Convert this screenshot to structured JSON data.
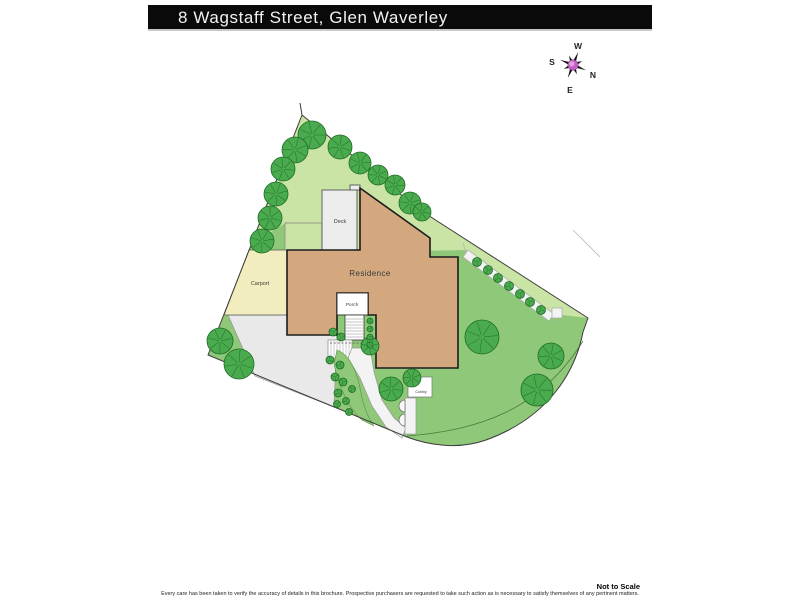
{
  "header": {
    "title": "8 Wagstaff Street, Glen Waverley"
  },
  "compass": {
    "north": "N",
    "south": "S",
    "east": "E",
    "west": "W"
  },
  "plan": {
    "labels": {
      "residence": "Residence",
      "deck": "Deck",
      "carport": "Carport",
      "porch": "Porch",
      "cubby": "Cubby"
    },
    "colors": {
      "lawn": "#8fc879",
      "lawn_light": "#c9e4a4",
      "tree_fill": "#4aaa4e",
      "tree_line": "#1d6b24",
      "driveway": "#e9e9e9",
      "carport": "#f2edbe",
      "residence": "#d3a87e",
      "outline": "#1c1c1c",
      "deck": "#ededed",
      "porch": "#ffffff",
      "path": "#f3f3f3",
      "boundary": "#3c3c3c",
      "compass_pink": "#c45fc4",
      "compass_pink_light": "#e49ce4",
      "header_bg": "#0a0a0a",
      "header_text": "#f2f2f2"
    },
    "trees": [
      {
        "x": 112,
        "y": 35,
        "r": 14
      },
      {
        "x": 95,
        "y": 50,
        "r": 13
      },
      {
        "x": 83,
        "y": 69,
        "r": 12
      },
      {
        "x": 76,
        "y": 94,
        "r": 12
      },
      {
        "x": 70,
        "y": 118,
        "r": 12
      },
      {
        "x": 62,
        "y": 141,
        "r": 12
      },
      {
        "x": 140,
        "y": 47,
        "r": 12
      },
      {
        "x": 160,
        "y": 63,
        "r": 11
      },
      {
        "x": 178,
        "y": 75,
        "r": 10
      },
      {
        "x": 195,
        "y": 85,
        "r": 10
      },
      {
        "x": 210,
        "y": 103,
        "r": 11
      },
      {
        "x": 222,
        "y": 112,
        "r": 9
      },
      {
        "x": 20,
        "y": 241,
        "r": 13
      },
      {
        "x": 39,
        "y": 264,
        "r": 15
      },
      {
        "x": 282,
        "y": 237,
        "r": 17
      },
      {
        "x": 351,
        "y": 256,
        "r": 13
      },
      {
        "x": 337,
        "y": 290,
        "r": 16
      },
      {
        "x": 212,
        "y": 278,
        "r": 9
      },
      {
        "x": 191,
        "y": 289,
        "r": 12
      },
      {
        "x": 170,
        "y": 246,
        "r": 9
      }
    ],
    "bushes": [
      {
        "x": 133,
        "y": 232,
        "r": 4
      },
      {
        "x": 141,
        "y": 237,
        "r": 4
      },
      {
        "x": 130,
        "y": 260,
        "r": 4
      },
      {
        "x": 140,
        "y": 265,
        "r": 4
      },
      {
        "x": 135,
        "y": 277,
        "r": 4
      },
      {
        "x": 143,
        "y": 282,
        "r": 4
      },
      {
        "x": 138,
        "y": 293,
        "r": 4
      },
      {
        "x": 146,
        "y": 301,
        "r": 3.5
      },
      {
        "x": 137,
        "y": 304,
        "r": 3.5
      },
      {
        "x": 152,
        "y": 289,
        "r": 3.5
      },
      {
        "x": 149,
        "y": 312,
        "r": 3.5
      },
      {
        "x": 170,
        "y": 221,
        "r": 3
      },
      {
        "x": 170,
        "y": 229,
        "r": 3
      },
      {
        "x": 170,
        "y": 237,
        "r": 3
      },
      {
        "x": 170,
        "y": 245,
        "r": 3
      }
    ],
    "hedge_bushes": [
      {
        "x": 277,
        "y": 162,
        "r": 4.5
      },
      {
        "x": 288,
        "y": 170,
        "r": 4.5
      },
      {
        "x": 298,
        "y": 178,
        "r": 4.5
      },
      {
        "x": 309,
        "y": 186,
        "r": 4.5
      },
      {
        "x": 320,
        "y": 194,
        "r": 4.5
      },
      {
        "x": 330,
        "y": 202,
        "r": 4.5
      },
      {
        "x": 341,
        "y": 210,
        "r": 4.5
      }
    ]
  },
  "footer": {
    "scale_note": "Not to Scale",
    "disclaimer": "Every care has been taken to verify the accuracy of details in this brochure. Prospective purchasers are requested to take such action as is necessary to satisfy themselves of any pertinent matters."
  }
}
